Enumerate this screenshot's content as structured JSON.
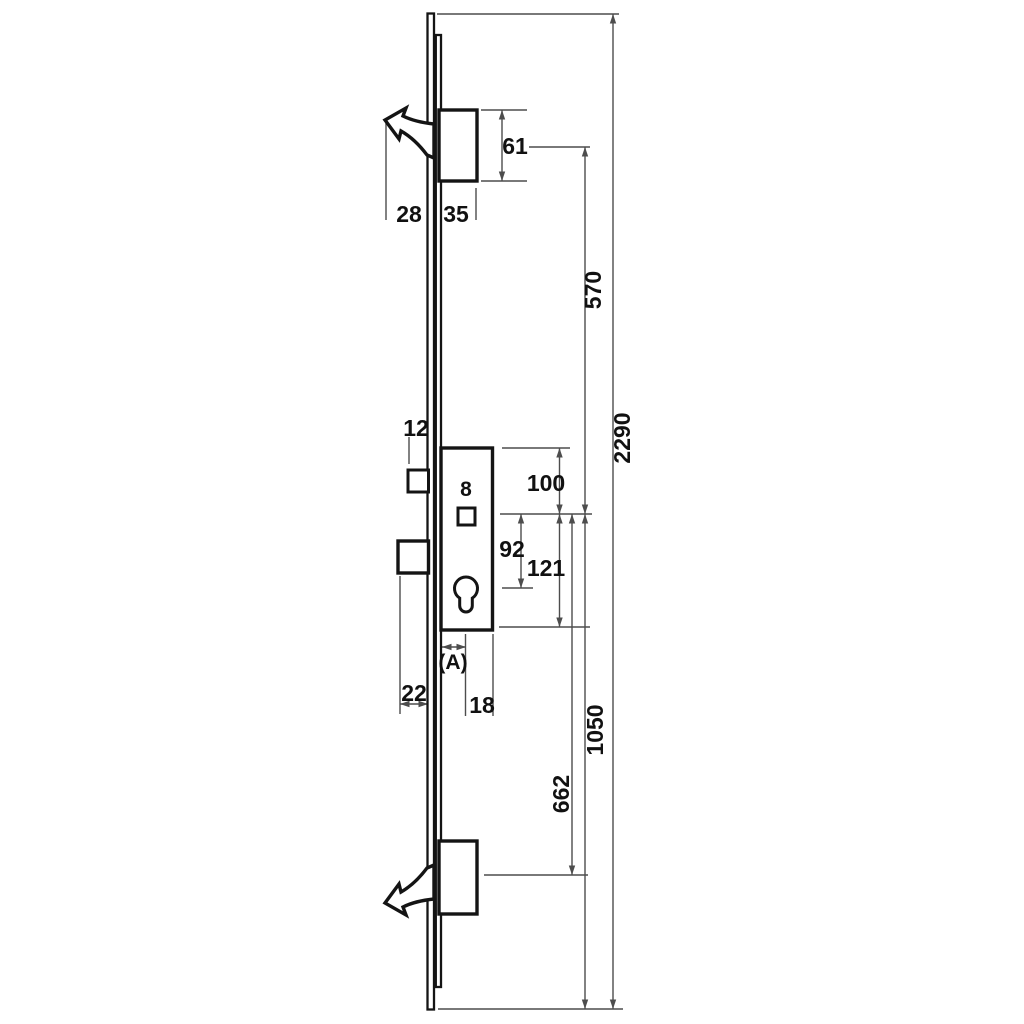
{
  "colors": {
    "background": "#ffffff",
    "part_stroke": "#141414",
    "dim_line": "#4d4d4d",
    "label_color": "#111111"
  },
  "diagram": {
    "dims": {
      "top_hook_projection": "28",
      "top_bolt_width": "35",
      "top_bolt_height": "61",
      "handle_to_top_hook": "570",
      "overall_length": "2290",
      "latch_projection": "12",
      "follower_width": "8",
      "case_top_to_follower": "100",
      "follower_to_cylinder": "92",
      "follower_to_case_bottom": "121",
      "backset_label": "(A)",
      "cylinder_to_case_back": "18",
      "deadbolt_projection": "22",
      "handle_to_bottom_hook": "662",
      "handle_to_bottom_end": "1050"
    }
  }
}
